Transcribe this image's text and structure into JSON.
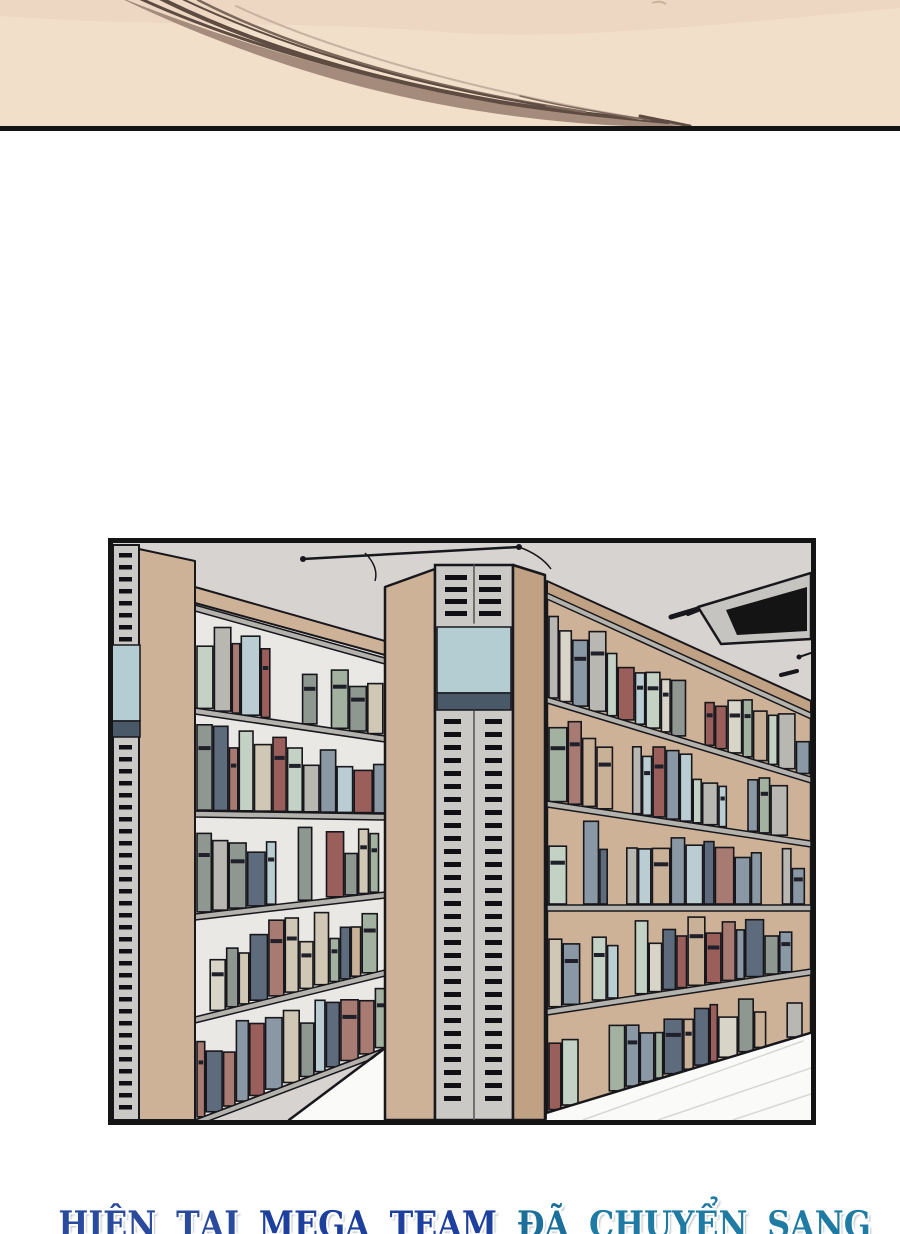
{
  "caption": {
    "text": "HIỆN TẠI MEGA TEAM ĐÃ CHUYỂN SANG",
    "words": [
      {
        "t": "HIỆN",
        "c": "#2a4a9d"
      },
      {
        "t": "TẠI",
        "c": "#2a4a9d"
      },
      {
        "t": "MEGA",
        "c": "#1d3f9e"
      },
      {
        "t": "TEAM",
        "c": "#1d3f9e"
      },
      {
        "t": "ĐÃ",
        "c": "#1b6f9a"
      },
      {
        "t": "CHUYỂN",
        "c": "#1f7ba3"
      },
      {
        "t": "SANG",
        "c": "#1f7ba3"
      }
    ]
  },
  "face_panel": {
    "skin": "#f2dfca",
    "shade": "#ecd5c1",
    "hair": "#a48b7b",
    "hair_dark": "#5e4b41",
    "hair_mid": "#7c675b",
    "hair_light": "#c7b1a0",
    "border": "#141414"
  },
  "library_panel": {
    "ceiling": "#d6d3d0",
    "outline": "#17171c",
    "wood": "#cdb298",
    "wood_dark": "#c0a184",
    "strip": "#cbc9c5",
    "slot": "#101014",
    "sign_blue": "#b3cdd3",
    "sign_band": "#4a5968",
    "shelf_board": "#b4b2ad",
    "back_left": "#e9e8e4",
    "floor": "#fafaf8",
    "tile_line": "#d9d7d3",
    "vent_frame": "#c6c4c0",
    "vent_dark": "#141414",
    "book_palette": [
      "#a87b72",
      "#9a5f5a",
      "#a3b1a0",
      "#c3d2c4",
      "#8a98a5",
      "#5d6b7c",
      "#d9d4c8",
      "#b9b7b2",
      "#c9b197",
      "#b9cdd2",
      "#8e9790",
      "#d0c7b4"
    ]
  }
}
